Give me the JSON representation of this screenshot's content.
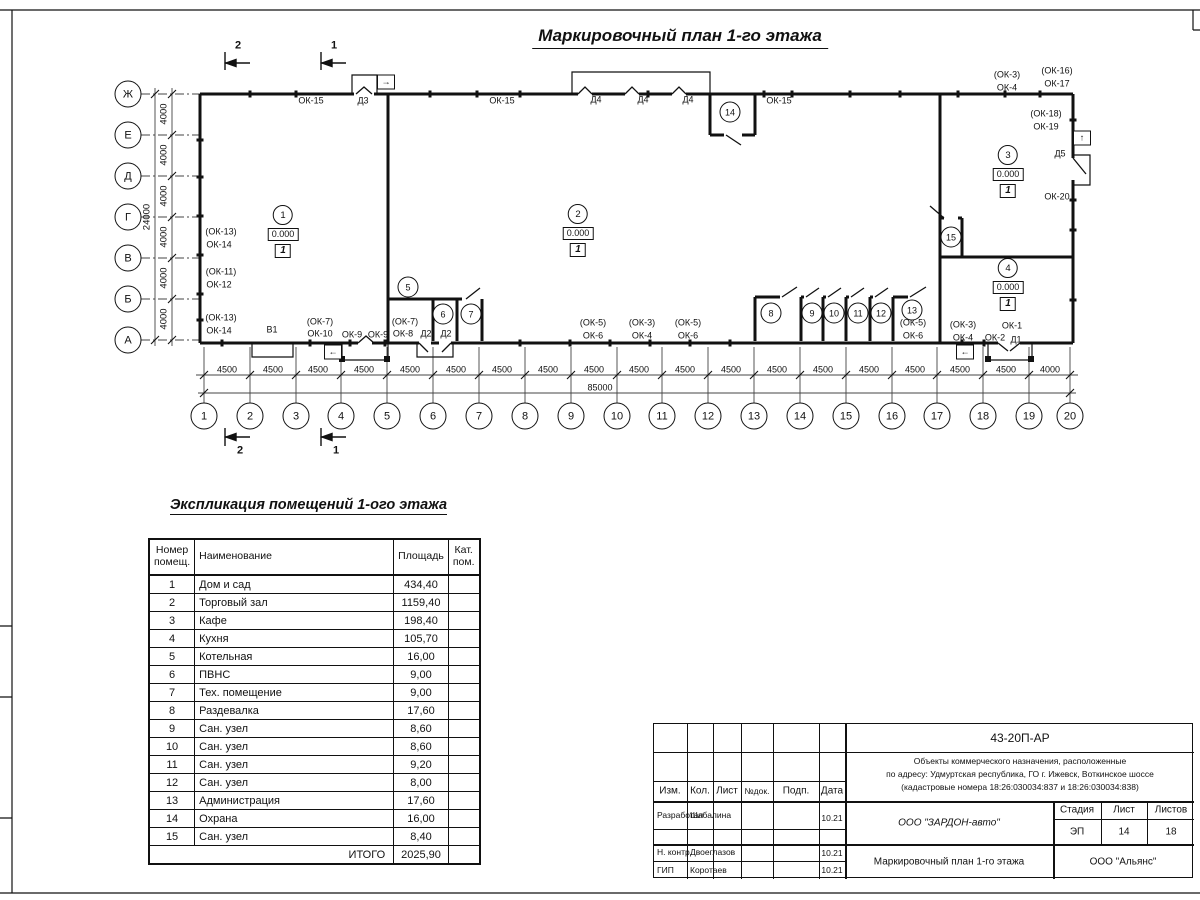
{
  "page": {
    "title": "Маркировочный план 1-го этажа"
  },
  "plan": {
    "axis_rows": [
      {
        "t": "Ж",
        "x": 128,
        "y": 94
      },
      {
        "t": "Е",
        "x": 128,
        "y": 135
      },
      {
        "t": "Д",
        "x": 128,
        "y": 176
      },
      {
        "t": "Г",
        "x": 128,
        "y": 217
      },
      {
        "t": "В",
        "x": 128,
        "y": 258
      },
      {
        "t": "Б",
        "x": 128,
        "y": 299
      },
      {
        "t": "А",
        "x": 128,
        "y": 340
      }
    ],
    "axis_cols": [
      {
        "t": "1",
        "x": 204,
        "y": 416
      },
      {
        "t": "2",
        "x": 250,
        "y": 416
      },
      {
        "t": "3",
        "x": 296,
        "y": 416
      },
      {
        "t": "4",
        "x": 341,
        "y": 416
      },
      {
        "t": "5",
        "x": 387,
        "y": 416
      },
      {
        "t": "6",
        "x": 433,
        "y": 416
      },
      {
        "t": "7",
        "x": 479,
        "y": 416
      },
      {
        "t": "8",
        "x": 525,
        "y": 416
      },
      {
        "t": "9",
        "x": 571,
        "y": 416
      },
      {
        "t": "10",
        "x": 617,
        "y": 416
      },
      {
        "t": "11",
        "x": 662,
        "y": 416
      },
      {
        "t": "12",
        "x": 708,
        "y": 416
      },
      {
        "t": "13",
        "x": 754,
        "y": 416
      },
      {
        "t": "14",
        "x": 800,
        "y": 416
      },
      {
        "t": "15",
        "x": 846,
        "y": 416
      },
      {
        "t": "16",
        "x": 892,
        "y": 416
      },
      {
        "t": "17",
        "x": 937,
        "y": 416
      },
      {
        "t": "18",
        "x": 983,
        "y": 416
      },
      {
        "t": "19",
        "x": 1029,
        "y": 416
      },
      {
        "t": "20",
        "x": 1070,
        "y": 416
      }
    ],
    "dims": [
      {
        "t": "4000",
        "x": 164,
        "y": 114,
        "cls": "rot"
      },
      {
        "t": "4000",
        "x": 164,
        "y": 155,
        "cls": "rot"
      },
      {
        "t": "4000",
        "x": 164,
        "y": 196,
        "cls": "rot"
      },
      {
        "t": "4000",
        "x": 164,
        "y": 237,
        "cls": "rot"
      },
      {
        "t": "4000",
        "x": 164,
        "y": 278,
        "cls": "rot"
      },
      {
        "t": "4000",
        "x": 164,
        "y": 319,
        "cls": "rot"
      },
      {
        "t": "24000",
        "x": 147,
        "y": 217,
        "cls": "rot"
      },
      {
        "t": "4500",
        "x": 227,
        "y": 370
      },
      {
        "t": "4500",
        "x": 273,
        "y": 370
      },
      {
        "t": "4500",
        "x": 318,
        "y": 370
      },
      {
        "t": "4500",
        "x": 364,
        "y": 370
      },
      {
        "t": "4500",
        "x": 410,
        "y": 370
      },
      {
        "t": "4500",
        "x": 456,
        "y": 370
      },
      {
        "t": "4500",
        "x": 502,
        "y": 370
      },
      {
        "t": "4500",
        "x": 548,
        "y": 370
      },
      {
        "t": "4500",
        "x": 594,
        "y": 370
      },
      {
        "t": "4500",
        "x": 639,
        "y": 370
      },
      {
        "t": "4500",
        "x": 685,
        "y": 370
      },
      {
        "t": "4500",
        "x": 731,
        "y": 370
      },
      {
        "t": "4500",
        "x": 777,
        "y": 370
      },
      {
        "t": "4500",
        "x": 823,
        "y": 370
      },
      {
        "t": "4500",
        "x": 869,
        "y": 370
      },
      {
        "t": "4500",
        "x": 915,
        "y": 370
      },
      {
        "t": "4500",
        "x": 960,
        "y": 370
      },
      {
        "t": "4500",
        "x": 1006,
        "y": 370
      },
      {
        "t": "4000",
        "x": 1050,
        "y": 370
      },
      {
        "t": "85000",
        "x": 600,
        "y": 388
      }
    ],
    "labels": [
      {
        "t": "ОК-15",
        "x": 311,
        "y": 101
      },
      {
        "t": "Д3",
        "x": 363,
        "y": 101
      },
      {
        "t": "ОК-15",
        "x": 502,
        "y": 101
      },
      {
        "t": "Д4",
        "x": 596,
        "y": 100
      },
      {
        "t": "Д4",
        "x": 643,
        "y": 100
      },
      {
        "t": "Д4",
        "x": 688,
        "y": 100
      },
      {
        "t": "ОК-15",
        "x": 779,
        "y": 101
      },
      {
        "t": "(ОК-3)",
        "x": 1007,
        "y": 75
      },
      {
        "t": "ОК-4",
        "x": 1007,
        "y": 88
      },
      {
        "t": "(ОК-16)",
        "x": 1057,
        "y": 71
      },
      {
        "t": "ОК-17",
        "x": 1057,
        "y": 84
      },
      {
        "t": "(ОК-18)",
        "x": 1046,
        "y": 114
      },
      {
        "t": "ОК-19",
        "x": 1046,
        "y": 127
      },
      {
        "t": "Д5",
        "x": 1060,
        "y": 154
      },
      {
        "t": "ОК-20",
        "x": 1057,
        "y": 197
      },
      {
        "t": "(ОК-13)",
        "x": 221,
        "y": 232
      },
      {
        "t": "ОК-14",
        "x": 219,
        "y": 245
      },
      {
        "t": "(ОК-11)",
        "x": 221,
        "y": 272
      },
      {
        "t": "ОК-12",
        "x": 219,
        "y": 285
      },
      {
        "t": "(ОК-13)",
        "x": 221,
        "y": 318
      },
      {
        "t": "ОК-14",
        "x": 219,
        "y": 331
      },
      {
        "t": "В1",
        "x": 272,
        "y": 330
      },
      {
        "t": "(ОК-7)",
        "x": 320,
        "y": 322
      },
      {
        "t": "ОК-10",
        "x": 320,
        "y": 334
      },
      {
        "t": "ОК-9",
        "x": 352,
        "y": 335
      },
      {
        "t": "ОК-9",
        "x": 378,
        "y": 335
      },
      {
        "t": "(ОК-7)",
        "x": 405,
        "y": 322
      },
      {
        "t": "ОК-8",
        "x": 403,
        "y": 334
      },
      {
        "t": "Д2",
        "x": 426,
        "y": 334
      },
      {
        "t": "Д2",
        "x": 446,
        "y": 334
      },
      {
        "t": "(ОК-5)",
        "x": 593,
        "y": 323
      },
      {
        "t": "ОК-6",
        "x": 593,
        "y": 336
      },
      {
        "t": "(ОК-3)",
        "x": 642,
        "y": 323
      },
      {
        "t": "ОК-4",
        "x": 642,
        "y": 336
      },
      {
        "t": "(ОК-5)",
        "x": 688,
        "y": 323
      },
      {
        "t": "ОК-6",
        "x": 688,
        "y": 336
      },
      {
        "t": "(ОК-5)",
        "x": 913,
        "y": 323
      },
      {
        "t": "ОК-6",
        "x": 913,
        "y": 336
      },
      {
        "t": "(ОК-3)",
        "x": 963,
        "y": 325
      },
      {
        "t": "ОК-4",
        "x": 963,
        "y": 338
      },
      {
        "t": "ОК-1",
        "x": 1012,
        "y": 326
      },
      {
        "t": "ОК-2",
        "x": 995,
        "y": 338
      },
      {
        "t": "Д1",
        "x": 1016,
        "y": 340
      },
      {
        "t": "2",
        "x": 238,
        "y": 46,
        "cls": "secnum"
      },
      {
        "t": "1",
        "x": 334,
        "y": 46,
        "cls": "secnum"
      },
      {
        "t": "2",
        "x": 240,
        "y": 451,
        "cls": "secnum"
      },
      {
        "t": "1",
        "x": 336,
        "y": 451,
        "cls": "secnum"
      }
    ],
    "exit_arrows": [
      {
        "t": "→",
        "x": 386,
        "y": 82
      },
      {
        "t": "↑",
        "x": 1082,
        "y": 138
      },
      {
        "t": "←",
        "x": 333,
        "y": 352
      },
      {
        "t": "←",
        "x": 965,
        "y": 352
      }
    ],
    "rooms_major": [
      {
        "num": "1",
        "elev": "0.000",
        "floor": "1",
        "x": 283,
        "y": 215
      },
      {
        "num": "2",
        "elev": "0.000",
        "floor": "1",
        "x": 578,
        "y": 214
      },
      {
        "num": "3",
        "elev": "0.000",
        "floor": "1",
        "x": 1008,
        "y": 155
      },
      {
        "num": "4",
        "elev": "0.000",
        "floor": "1",
        "x": 1008,
        "y": 268
      }
    ],
    "rooms_minor": [
      {
        "t": "5",
        "x": 408,
        "y": 287
      },
      {
        "t": "6",
        "x": 443,
        "y": 314
      },
      {
        "t": "7",
        "x": 471,
        "y": 314
      },
      {
        "t": "8",
        "x": 771,
        "y": 313
      },
      {
        "t": "9",
        "x": 812,
        "y": 313
      },
      {
        "t": "10",
        "x": 834,
        "y": 313
      },
      {
        "t": "11",
        "x": 858,
        "y": 313
      },
      {
        "t": "12",
        "x": 881,
        "y": 313
      },
      {
        "t": "13",
        "x": 912,
        "y": 310
      },
      {
        "t": "14",
        "x": 730,
        "y": 112
      },
      {
        "t": "15",
        "x": 951,
        "y": 237
      }
    ]
  },
  "explication": {
    "title": "Экспликация помещений 1-ого этажа",
    "headers": {
      "num": "Номер помещ.",
      "name": "Наименование",
      "area": "Площадь",
      "cat": "Кат. пом."
    },
    "rows": [
      {
        "num": "1",
        "name": "Дом и сад",
        "area": "434,40",
        "cat": ""
      },
      {
        "num": "2",
        "name": "Торговый зал",
        "area": "1159,40",
        "cat": ""
      },
      {
        "num": "3",
        "name": "Кафе",
        "area": "198,40",
        "cat": ""
      },
      {
        "num": "4",
        "name": "Кухня",
        "area": "105,70",
        "cat": ""
      },
      {
        "num": "5",
        "name": "Котельная",
        "area": "16,00",
        "cat": ""
      },
      {
        "num": "6",
        "name": "ПВНС",
        "area": "9,00",
        "cat": ""
      },
      {
        "num": "7",
        "name": "Тех. помещение",
        "area": "9,00",
        "cat": ""
      },
      {
        "num": "8",
        "name": "Раздевалка",
        "area": "17,60",
        "cat": ""
      },
      {
        "num": "9",
        "name": "Сан. узел",
        "area": "8,60",
        "cat": ""
      },
      {
        "num": "10",
        "name": "Сан. узел",
        "area": "8,60",
        "cat": ""
      },
      {
        "num": "11",
        "name": "Сан. узел",
        "area": "9,20",
        "cat": ""
      },
      {
        "num": "12",
        "name": "Сан. узел",
        "area": "8,00",
        "cat": ""
      },
      {
        "num": "13",
        "name": "Администрация",
        "area": "17,60",
        "cat": ""
      },
      {
        "num": "14",
        "name": "Охрана",
        "area": "16,00",
        "cat": ""
      },
      {
        "num": "15",
        "name": "Сан. узел",
        "area": "8,40",
        "cat": ""
      }
    ],
    "total_label": "ИТОГО",
    "total_value": "2025,90"
  },
  "title_block": {
    "doc_number": "43-20П-АР",
    "project_lines": [
      "Объекты коммерческого назначения, расположенные",
      "по адресу: Удмуртская республика, ГО г. Ижевск, Воткинское шоссе",
      "(кадастровые номера 18:26:030034:837 и 18:26:030034:838)"
    ],
    "cols": {
      "izm": "Изм.",
      "kol": "Кол.",
      "list": "Лист",
      "ndoc": "№док.",
      "podp": "Подп.",
      "data": "Дата"
    },
    "rows": [
      {
        "role": "Разработал",
        "name": "Шабалина",
        "date": "10.21"
      },
      {
        "role": "Н. контр.",
        "name": "Двоеглазов",
        "date": "10.21"
      },
      {
        "role": "ГИП",
        "name": "Коротаев",
        "date": "10.21"
      }
    ],
    "org": "ООО \"ЗАРДОН-авто\"",
    "sheet_title": "Маркировочный план 1-го этажа",
    "contractor": "ООО \"Альянс\"",
    "stage_label": "Стадия",
    "sheet_label": "Лист",
    "sheets_label": "Листов",
    "stage": "ЭП",
    "sheet": "14",
    "sheets": "18"
  }
}
